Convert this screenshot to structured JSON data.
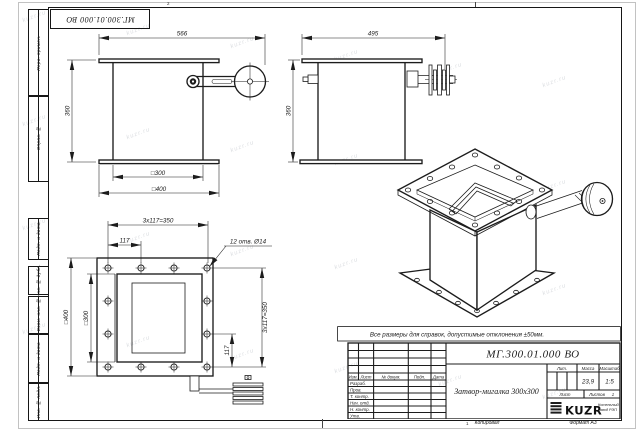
{
  "meta": {
    "watermark": "kuzr.ru"
  },
  "frame": {
    "top_stamp": "МГ.300.01.000 ВО",
    "zone_top": "2",
    "zone_bottom": "1",
    "side_columns": [
      "Перв. примен.",
      "Справ. №",
      "Подп. и дата",
      "Инв. № дубл.",
      "Взам. инв. №",
      "Подп. и дата",
      "Инв. № подл."
    ]
  },
  "dims": {
    "front_width": "566",
    "front_height": "360",
    "front_inner": "□300",
    "front_outer": "□400",
    "side_width": "495",
    "side_height": "360",
    "plan_pitch_top": "3х117=350",
    "plan_pitch_top_small": "117",
    "plan_holes_note": "12 отв. Ø14",
    "plan_outer": "□400",
    "plan_inner": "□300",
    "plan_pitch_right": "3х117=350",
    "plan_pitch_right_small": "117"
  },
  "note": "Все размеры для справок, допустимые отклонения ±50мм.",
  "title_block": {
    "doc_number": "МГ.300.01.000 ВО",
    "part_name": "Затвор-мигалка 300х300",
    "header_cells": [
      "Изм.",
      "Лист",
      "№ докум.",
      "Подп.",
      "Дата"
    ],
    "rows": [
      "Разраб.",
      "Пров.",
      "Т. контр.",
      "Нач. отд.",
      "Н. контр.",
      "Утв."
    ],
    "lit_label": "Лит.",
    "mass_label": "Масса",
    "scale_label": "Масштаб",
    "mass_value": "23,9",
    "scale_value": "1:5",
    "sheet_label": "Лист",
    "sheets_label": "Листов",
    "sheets_value": "1",
    "logo_text": "KUZR",
    "company_line1": "Котельный",
    "company_line2": "завод РЭП",
    "copied_label": "Копировал",
    "format_label": "Формат А3"
  }
}
